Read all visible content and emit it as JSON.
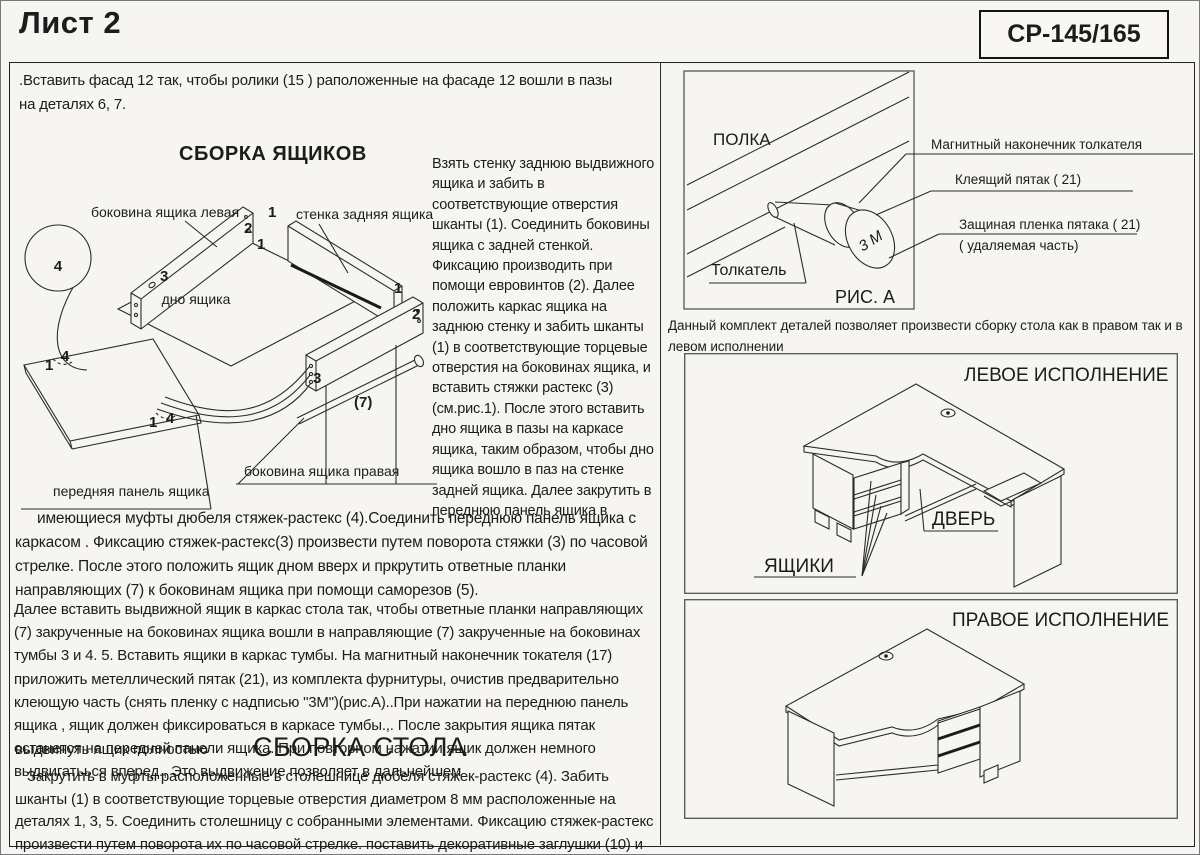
{
  "page": {
    "sheet_title": "Лист 2",
    "model_code": "СР-145/165"
  },
  "left": {
    "intro": ".Вставить фасад 12 так, чтобы ролики (15 ) раположенные на фасаде 12 вошли в пазы на деталях 6, 7.",
    "drawers_heading": "СБОРКА ЯЩИКОВ",
    "diagram": {
      "step_number": "4",
      "labels": {
        "side_left": "боковина ящика левая",
        "back_wall": "стенка задняя ящика",
        "bottom": "дно ящика",
        "side_right": "боковина ящика правая",
        "front_panel": "передняя панель ящика"
      },
      "callouts": [
        "1",
        "2",
        "1",
        "3",
        "1",
        "2",
        "3",
        "(7)",
        "4",
        "1",
        "4",
        "1"
      ]
    },
    "column_text": "Взять стенку заднюю выдвижного ящика и забить в соответствующие отверстия шканты (1). Соединить боковины ящика с задней стенкой. Фиксацию производить при помощи евровинтов (2). Далее положить каркас ящика на заднюю стенку  и забить шканты (1) в соответствующие  торцевые отверстия на боковинах ящика, и вставить стяжки растекс (3) (см.рис.1). После этого вставить дно ящика  в пазы на каркасе ящика, таким образом, чтобы дно ящика  вошло в паз на стенке задней ящика. Далее закрутить в переднюю панель ящика в",
    "para1": "имеющиеся муфты дюбеля стяжек-растекс (4).Соединить переднюю панель ящика с каркасом . Фиксацию стяжек-растекс(3) произвести путем поворота стяжки (3) по часовой стрелке. После этого положить ящик дном вверх и пркрутить ответные планки направляющих  (7) к боковинам ящика при помощи саморезов (5).",
    "para2": "Далее вставить выдвижной ящик в каркас стола так, чтобы ответные планки направляющих (7) закрученные на боковинах ящика  вошли в направляющие (7) закрученные на боковинах тумбы 3 и 4. 5. Вставить ящики в каркас тумбы. На магнитный наконечник токателя (17) приложить метеллический пятак (21), из комплекта фурнитуры, очистив предварительно клеющую часть (снять пленку с надписью \"3М\")(рис.А)..При нажатии на переднюю панель ящика , ящик должен фиксироваться в каркасе тумбы.,.  После закрытия ящика пятак останется на передней панели ящика. При повторном нажатии ящик должен немного выдвигатьься вперед., Это выдвижение позволяет в дальнейшем",
    "para2_tail": "выдвинуть ящик полностью",
    "desk_heading": "СБОРКА СТОЛА",
    "para3": "Закрутить в муфты расположенные в столешнице  дюбеля стяжек-растекс (4). Забить шканты (1) в соответствующие торцевые отверстия диаметром 8 мм расположенные на деталях 1, 3, 5. Соединить столешницу с собранными элементами. Фиксацию стяжек-растекс произвести путем поворота их по часовой стрелке. поставить декоративные заглушки (10) и (11)."
  },
  "right": {
    "fig_a": {
      "shelf_label": "ПОЛКА",
      "pusher_label": "Толкатель",
      "caption": "РИС. А",
      "magnet_tip": "Магнитный наконечник толкателя",
      "glue_disc": "Клеящий пятак  ( 21)",
      "film_line1": "Защиная пленка пятака  ( 21)",
      "film_line2": "( удаляемая часть)",
      "disc_text": "3 М"
    },
    "note": "Данный комплект деталей позволяет произвести сборку стола как в правом так и в левом исполнении",
    "left_version": {
      "title": "ЛЕВОЕ ИСПОЛНЕНИЕ",
      "door_label": "ДВЕРЬ",
      "drawers_label": "ЯЩИКИ"
    },
    "right_version": {
      "title": "ПРАВОЕ ИСПОЛНЕНИЕ"
    }
  }
}
